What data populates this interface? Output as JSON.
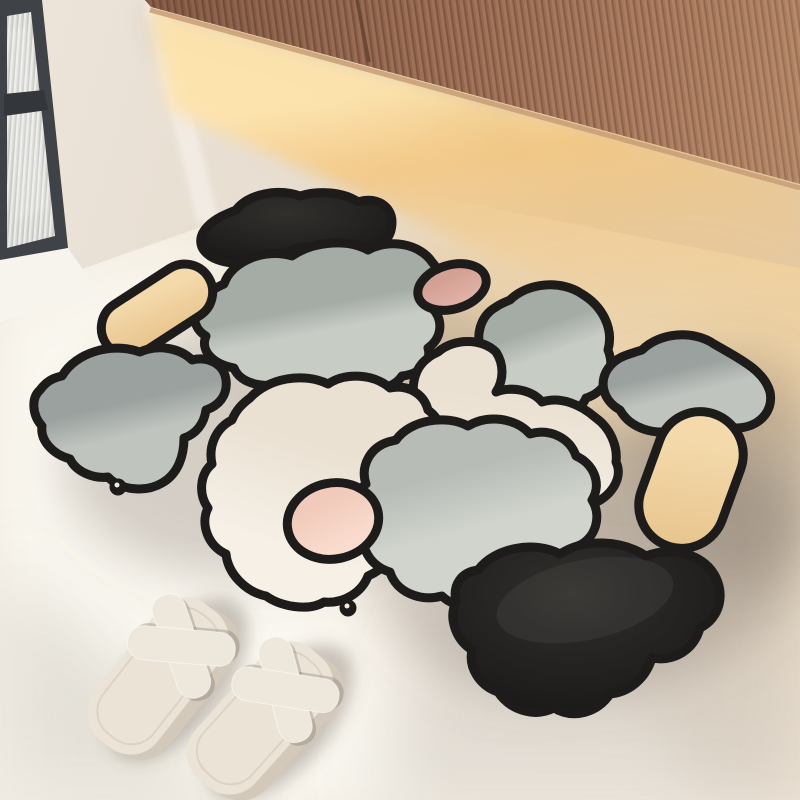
{
  "scene": {
    "type": "product lifestyle photo",
    "description": "Irregular patchwork diatomite bath mat with thick black outlines laid on a cream floor beneath a fluted wood wall cabinet with warm under-cabinet lighting; dark-framed ribbed-glass window at left; pair of cream cross-strap slippers at lower left.",
    "objects": [
      "fluted wood wall cabinet",
      "warm under-cabinet light glow",
      "dark framed window with ribbed privacy glass",
      "white windowsill",
      "cream floor with diagonal window light band",
      "abstract pebble patchwork bath mat",
      "pair of cream cross-strap slippers"
    ]
  },
  "mat": {
    "style": "abstract pebble patchwork, thick black outlines, small hanger tabs with holes",
    "pieces": [
      {
        "name": "black-boot-top",
        "color_key": "mat_black"
      },
      {
        "name": "tan-pill-left",
        "color_key": "tan"
      },
      {
        "name": "gray-boot-left",
        "color_key": "gray"
      },
      {
        "name": "sage-cloud-top-center",
        "color_key": "sage"
      },
      {
        "name": "pink-dot-top",
        "color_key": "pink"
      },
      {
        "name": "sage-blob-right",
        "color_key": "sage"
      },
      {
        "name": "gray-diamond-right",
        "color_key": "gray"
      },
      {
        "name": "cream-cloud-center-right",
        "color_key": "cream"
      },
      {
        "name": "cream-cloud-left",
        "color_key": "cream"
      },
      {
        "name": "gray-cloud-bottom",
        "color_key": "gray_soft"
      },
      {
        "name": "pink-dot-bottom",
        "color_key": "pink_light"
      },
      {
        "name": "tan-pill-right",
        "color_key": "tan"
      },
      {
        "name": "black-heart-bottom",
        "color_key": "mat_black"
      }
    ],
    "tab_count": 2
  },
  "slippers": {
    "count": 2,
    "style": "cross-strap square-toe slides",
    "color_name": "cream"
  },
  "palette": {
    "floor_light": "#f2ece3",
    "floor_mid": "#efe7dc",
    "floor_tan": "#e7d9c4",
    "floor_warm": "#eed2a4",
    "wall": "#ece4da",
    "wall_mid": "#e7ddd0",
    "wall_warm": "#ddcab1",
    "wall_hi": "#f4eee6",
    "wood": "#a5775e",
    "wood_mid": "#97694f",
    "wood_groove": "#7f5642",
    "wood_rim": "#c99e74",
    "glow": "#f6c67b",
    "glow_core": "#fde3ac",
    "win_frame": "#3f4247",
    "win_frame_dark": "#33363a",
    "glass_light": "#ececea",
    "glass_mid": "#d9d9d5",
    "glass_dark": "#c7c7c3",
    "sill": "#f7f4ee",
    "mat_black": "#1d1c1b",
    "sage_dark": "#a5aca6",
    "sage_light": "#c7ccc5",
    "gray_dark": "#9ba19e",
    "gray_light": "#bfc4bf",
    "grayb_dark": "#b7bcb6",
    "grayb_light": "#d0d4cd",
    "cream_dark": "#eae1d2",
    "cream_light": "#f6f0e7",
    "pink_dark": "#d3a094",
    "pink_mid": "#e2b2a6",
    "pink2_dark": "#f1cabb",
    "pink2_light": "#f9dcce",
    "tan_dark": "#e9c690",
    "tan_light": "#f4daab",
    "slipper": "#eae3d6",
    "slipper_side": "#d2c9ba",
    "slipper_strap": "#eee8dc",
    "shadow": "rgba(115,101,85,0.28)",
    "shadow_deep": "rgba(95,83,68,0.32)",
    "light_band": "rgba(255,253,247,0.45)",
    "light_band_core": "rgba(255,255,251,0.42)",
    "corner_shade": "rgba(140,128,110,0.20)",
    "right_shade": "rgba(150,143,132,0.22)",
    "warm_pool": "rgba(245,199,127,0.30)",
    "cab_shadow": "rgba(100,70,45,0.20)"
  }
}
